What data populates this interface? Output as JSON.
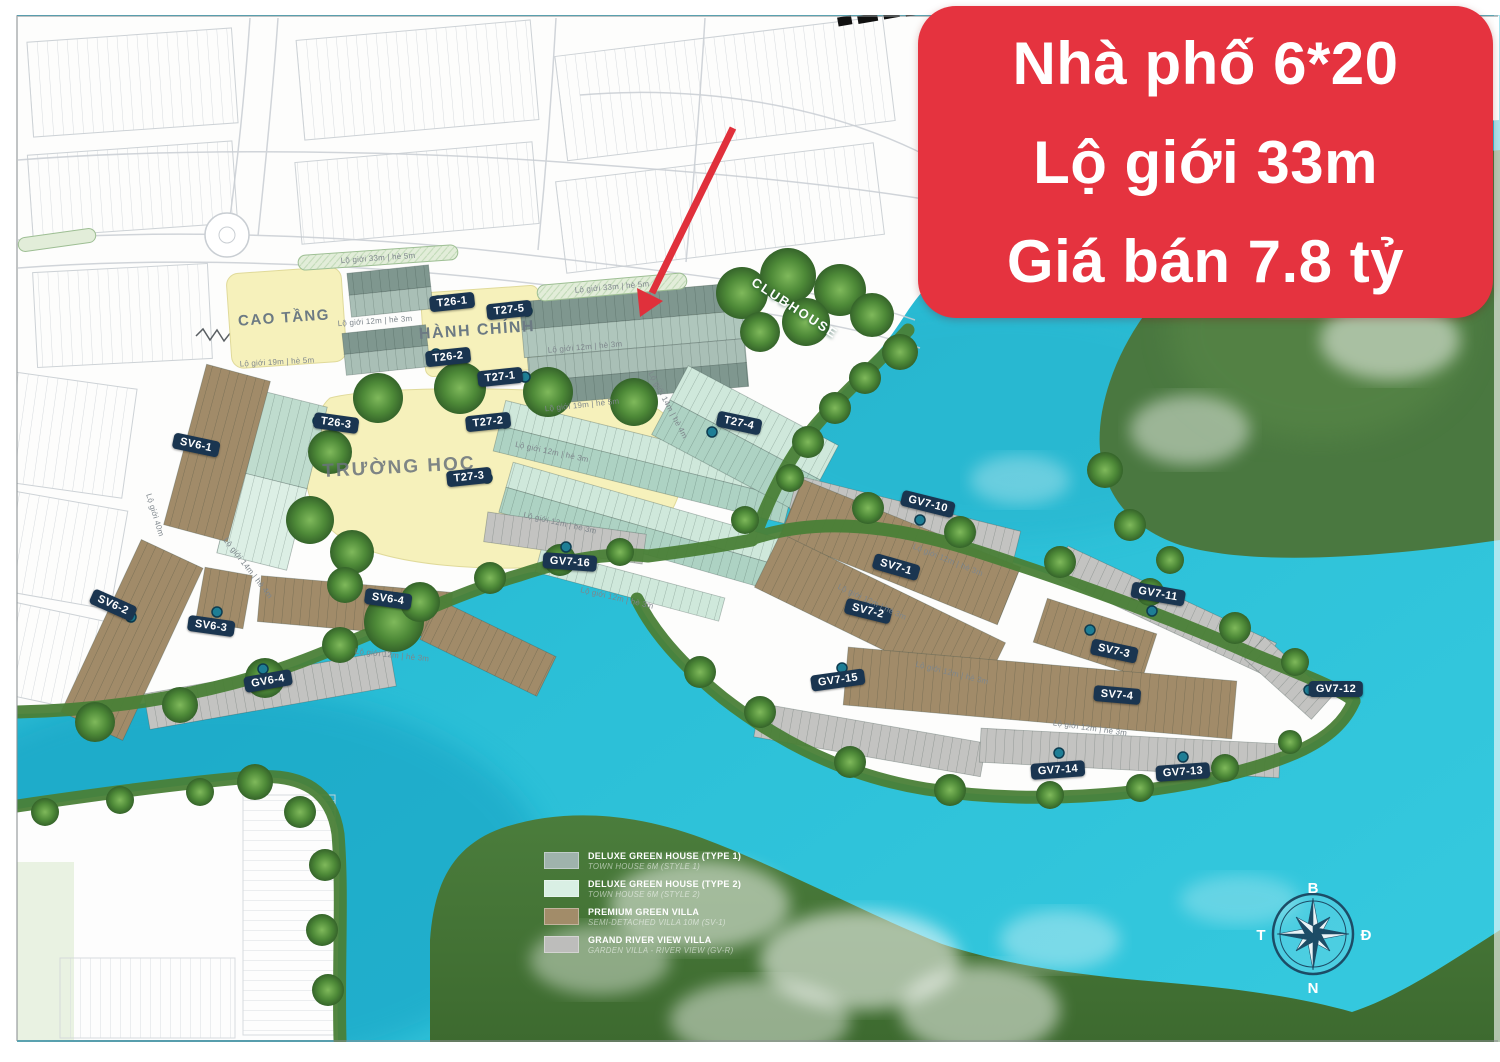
{
  "banner": {
    "lines": [
      "Nhà phố 6*20",
      "Lộ giới 33m",
      "Giá bán 7.8 tỷ"
    ],
    "bg_color": "#E5333F",
    "text_color": "#FFFFFF"
  },
  "zones": {
    "cao_tang": "CAO TẦNG",
    "hanh_chinh": "HÀNH CHÍNH",
    "truong_hoc": "TRƯỜNG HỌC",
    "clubhouse": "CLUBHOUSE"
  },
  "blocks": [
    {
      "label": "T26-1"
    },
    {
      "label": "T27-5"
    },
    {
      "label": "T26-2"
    },
    {
      "label": "T27-1"
    },
    {
      "label": "T26-3"
    },
    {
      "label": "T27-2"
    },
    {
      "label": "T27-3"
    },
    {
      "label": "T27-4"
    },
    {
      "label": "SV6-1"
    },
    {
      "label": "SV6-2"
    },
    {
      "label": "SV6-3"
    },
    {
      "label": "SV6-4"
    },
    {
      "label": "GV6-4"
    },
    {
      "label": "GV7-16"
    },
    {
      "label": "SV7-1"
    },
    {
      "label": "SV7-2"
    },
    {
      "label": "SV7-3"
    },
    {
      "label": "SV7-4"
    },
    {
      "label": "GV7-10"
    },
    {
      "label": "GV7-11"
    },
    {
      "label": "GV7-12"
    },
    {
      "label": "GV7-13"
    },
    {
      "label": "GV7-14"
    },
    {
      "label": "GV7-15"
    }
  ],
  "roads": {
    "r33": "Lộ giới 33m | hè 5m",
    "r19": "Lộ giới 19m | hè 5m",
    "r12": "Lộ giới 12m | hè 3m",
    "r14": "Lộ giới 14m | hè 4m",
    "r40": "Lộ giới 40m"
  },
  "legend": {
    "items": [
      {
        "color": "#9FB3AC",
        "title": "DELUXE GREEN HOUSE (TYPE 1)",
        "sub": "TOWN HOUSE 6M (STYLE 1)"
      },
      {
        "color": "#D9EFE4",
        "title": "DELUXE GREEN HOUSE (TYPE 2)",
        "sub": "TOWN HOUSE 6M (STYLE 2)"
      },
      {
        "color": "#A28C69",
        "title": "PREMIUM GREEN VILLA",
        "sub": "SEMI-DETACHED VILLA 10M (SV-1)"
      },
      {
        "color": "#BDBDBB",
        "title": "GRAND RIVER VIEW VILLA",
        "sub": "GARDEN VILLA - RIVER VIEW (GV-R)"
      }
    ]
  },
  "compass": {
    "north": "B",
    "east": "Đ",
    "south": "N",
    "west": "T"
  },
  "colors": {
    "water": "#2BBFD7",
    "banner_red": "#E5333F",
    "label_navy": "#1A3550",
    "zone_yellow": "#F6F1BB",
    "type1_green_house": "#8FA69E",
    "type2_green_house": "#D9EEE3",
    "premium_villa_brown": "#A18B69",
    "grand_villa_gray": "#C3C3C1",
    "shore_green": "#4A8037"
  }
}
